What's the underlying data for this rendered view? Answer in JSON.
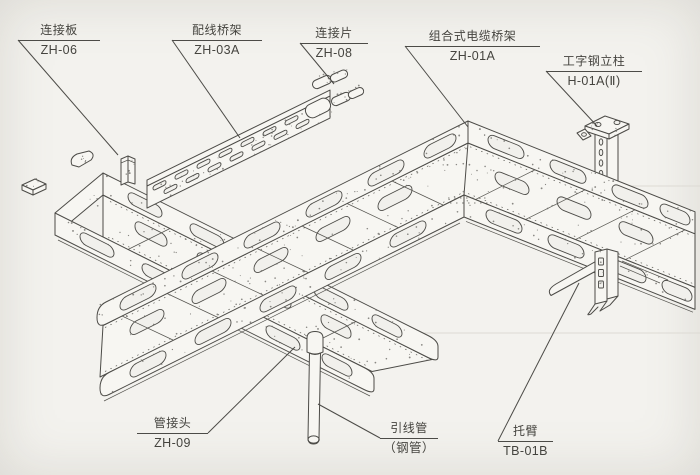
{
  "canvas": {
    "background": "#f3f2ee",
    "line_color": "#4c4b47",
    "text_color": "#45443f"
  },
  "labels": [
    {
      "name": "连接板",
      "code": "ZH-06"
    },
    {
      "name": "配线桥架",
      "code": "ZH-03A"
    },
    {
      "name": "连接片",
      "code": "ZH-08"
    },
    {
      "name": "组合式电缆桥架",
      "code": "ZH-01A"
    },
    {
      "name": "工字钢立柱",
      "code": "H-01A(Ⅱ)"
    },
    {
      "name": "管接头",
      "code": "ZH-09"
    },
    {
      "name": "引线管",
      "code": "（钢管）"
    },
    {
      "name": "托臂",
      "code": "TB-01B"
    }
  ],
  "components": [
    "connection-plate",
    "wiring-cable-tray",
    "connection-strip",
    "assembled-cable-tray",
    "i-beam-column",
    "pipe-joint",
    "lead-wire-steel-pipe",
    "support-arm"
  ]
}
